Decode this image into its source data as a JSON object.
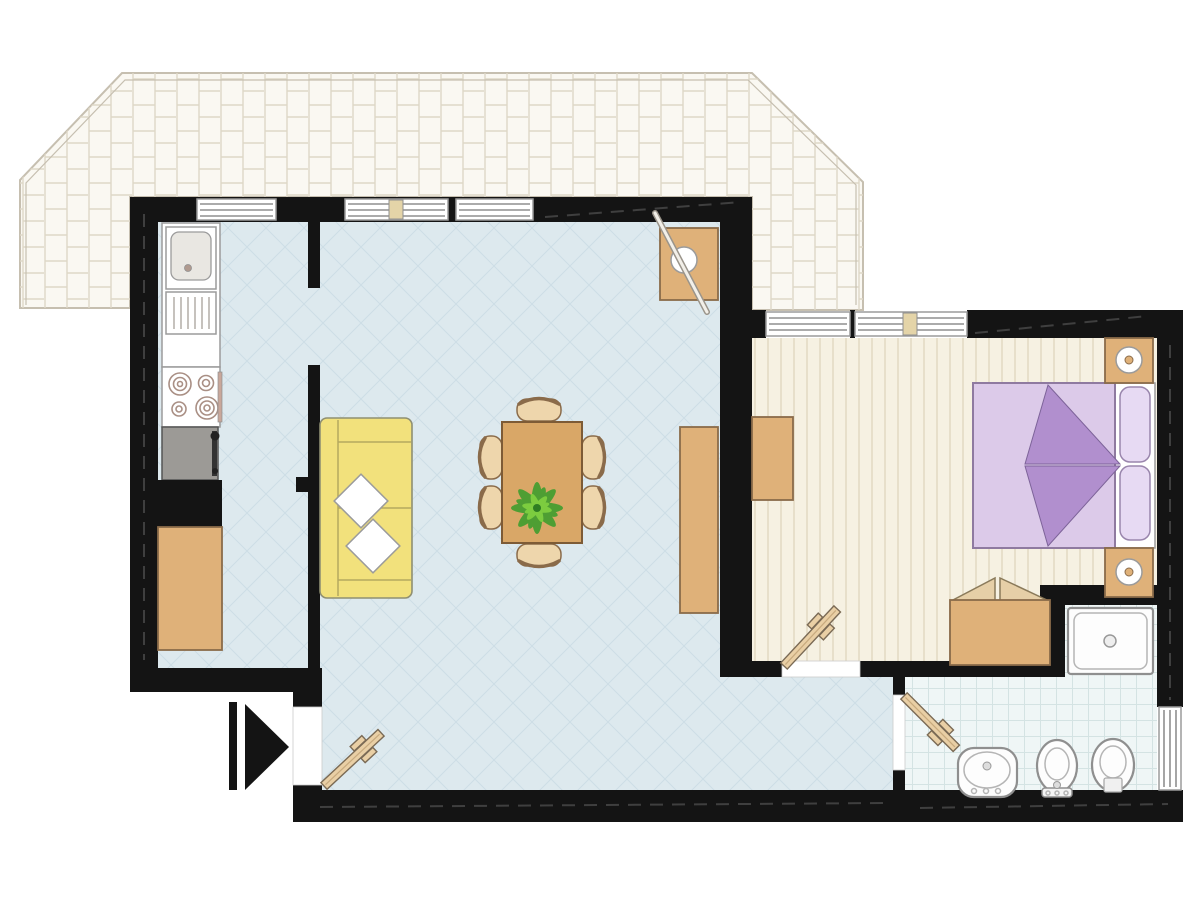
{
  "document": {
    "kind": "apartment-floor-plan",
    "visible_text": [],
    "rooms": [
      {
        "name": "terrace",
        "floor": "brick-paving"
      },
      {
        "name": "kitchen",
        "floor": "light-blue"
      },
      {
        "name": "living-dining-room",
        "floor": "light-blue-lattice"
      },
      {
        "name": "bedroom",
        "floor": "cream-stripes"
      },
      {
        "name": "bathroom",
        "floor": "light-tile-grid"
      }
    ],
    "furniture": {
      "kitchen": [
        "sink-with-drainer",
        "counter",
        "stove-4-burners",
        "gray-appliance",
        "tall-black-cabinet",
        "tan-cabinet"
      ],
      "living_dining": [
        "yellow-sofa",
        "two-throw-pillows",
        "dining-table",
        "six-chairs",
        "potted-plant",
        "sideboard",
        "corner-unit-with-lamp"
      ],
      "bedroom": [
        "double-bed",
        "two-pillows",
        "folded-purple-blanket",
        "nightstand-with-lamp-top",
        "nightstand-with-lamp-bottom",
        "open-chest",
        "wall-cabinet"
      ],
      "bathroom": [
        "shower-tray",
        "washbasin",
        "bidet",
        "toilet"
      ]
    },
    "openings": {
      "windows_count": 6,
      "doors": [
        "entry-door-with-arrow",
        "bedroom-door",
        "bathroom-door"
      ],
      "entry_marker": "black-triangle-arrow-pointing-right"
    }
  },
  "colors": {
    "wall": "#141414",
    "living_floor": "#dde9ee",
    "bedroom_floor": "#f6f1e2",
    "bathroom_floor": "#eff6f6",
    "terrace": "#faf8f2",
    "furniture_tan": "#dfb179",
    "furniture_tan_dark": "#8a6b4a",
    "chair_seat": "#eed6ac",
    "table_top": "#d9a767",
    "sofa_yellow": "#f2e17c",
    "bed_lavender": "#dccae9",
    "bed_accent": "#b18fce",
    "pillow_lavender": "#e7daf3",
    "plant_dark": "#3f9e2e",
    "plant_light": "#7ccc3f",
    "appliance_gray": "#9c9a96",
    "fixture_white": "#fdfdfd",
    "window_mullion": "#e4d4a8"
  }
}
